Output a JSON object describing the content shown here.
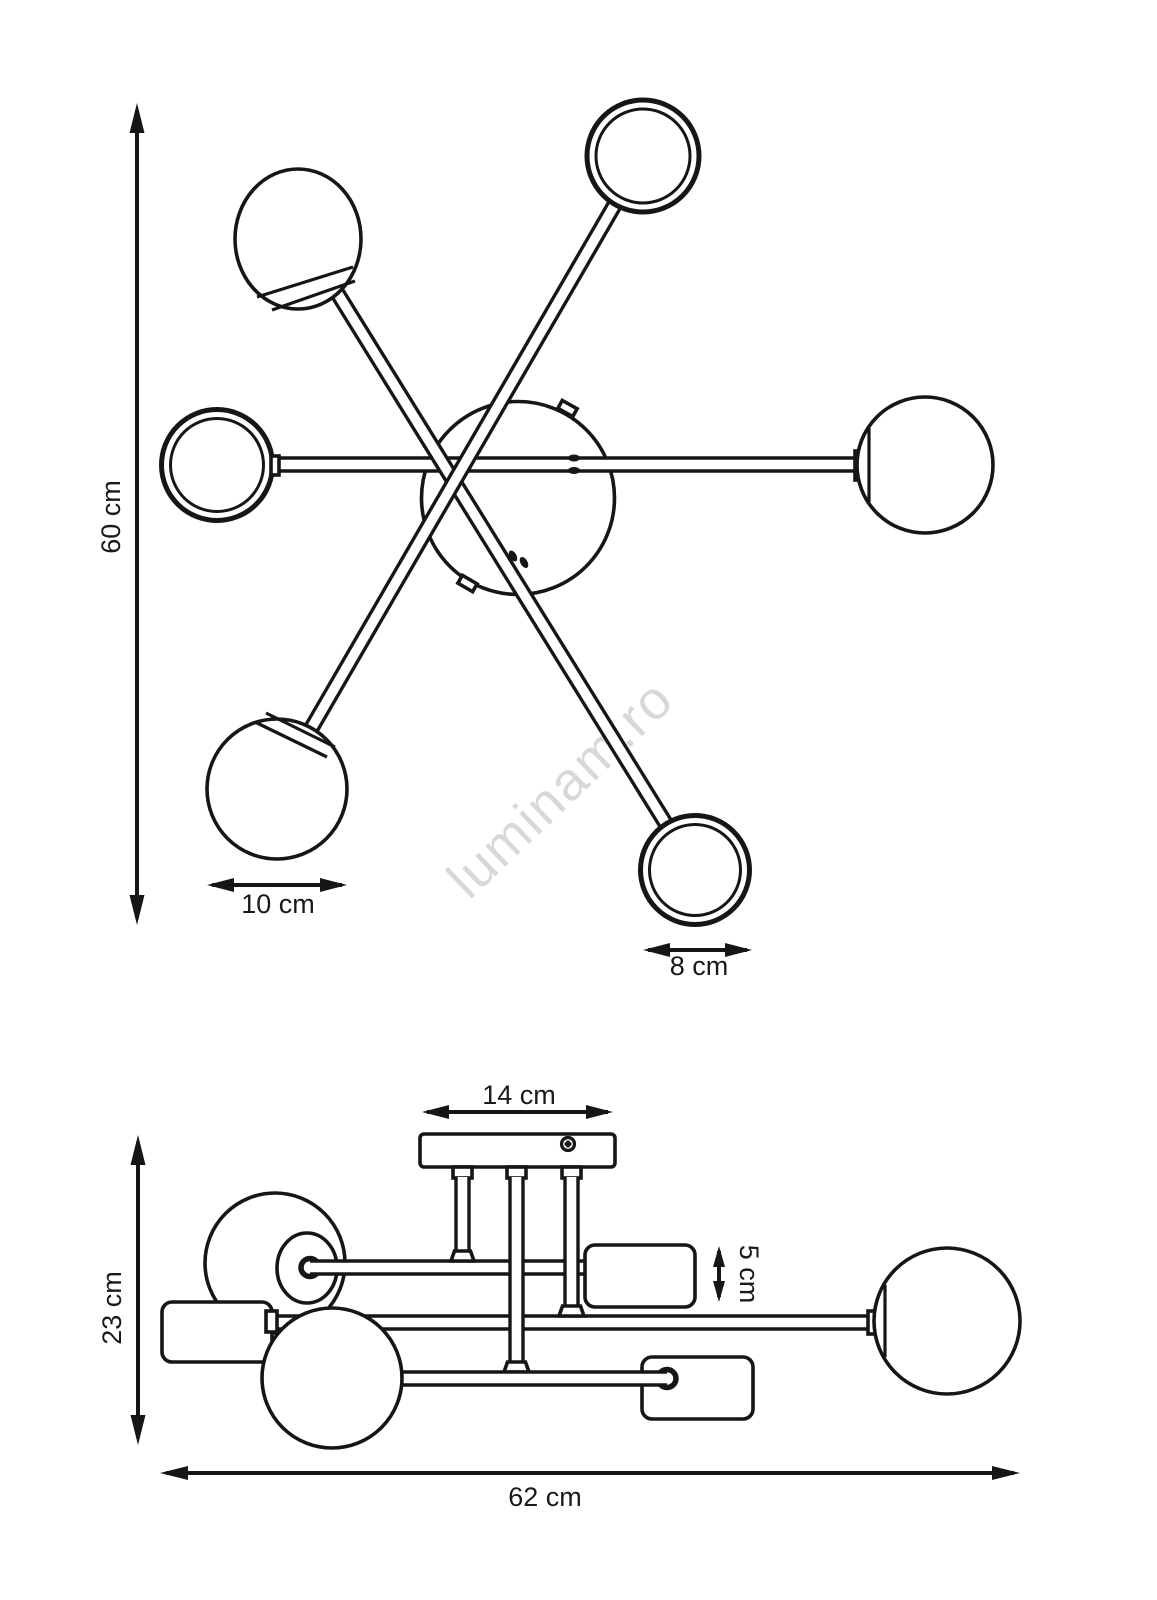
{
  "watermark": "luminam.ro",
  "top_view": {
    "height_label": "60 cm",
    "large_shade_label": "10 cm",
    "small_shade_label": "8 cm"
  },
  "side_view": {
    "canopy_width_label": "14 cm",
    "shade_height_label": "5 cm",
    "total_height_label": "23 cm",
    "total_width_label": "62 cm"
  }
}
